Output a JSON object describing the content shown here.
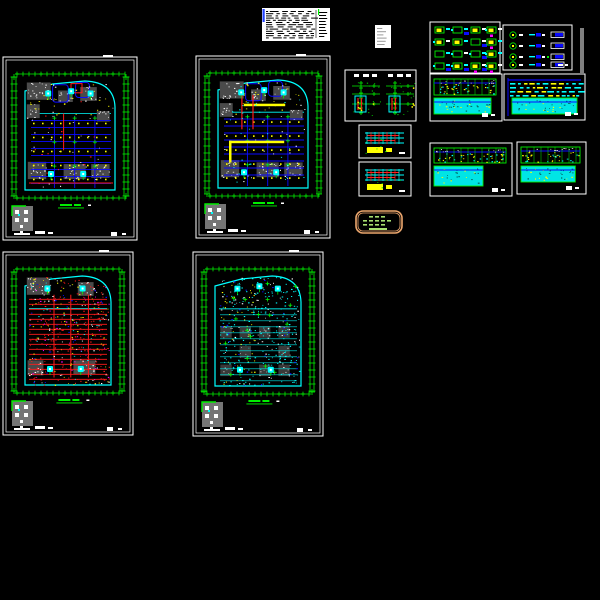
{
  "app": {
    "description": "CAD drawing set - basement electrical floor plans with legends and schedules",
    "background": "#000000"
  },
  "palette": {
    "border": "#ffffff",
    "dim_green": "#00ef00",
    "wall_cyan": "#00ffff",
    "grid_blue": "#0a0aff",
    "accent_red": "#ff1a1a",
    "light_yellow": "#ffff00",
    "hatch_gray": "#4a4a4a",
    "hatch_gray_dark": "#3a3a3a",
    "magenta": "#ff00ff",
    "stamp_orange": "#eda76e",
    "stamp_text": "#a8e070",
    "paper_white": "#ffffff",
    "ink_black": "#000000",
    "soft_gray": "#9a9a9a",
    "key_gray": "#757575",
    "table_cyan": "#00e5e5"
  },
  "sheets": [
    {
      "id": "sheet-plan-top-left",
      "name": "floorplan-sheet-1",
      "x": 3,
      "y": 57,
      "w": 134,
      "h": 183,
      "style": "mixed",
      "seed": 101
    },
    {
      "id": "sheet-plan-top-mid",
      "name": "floorplan-sheet-2",
      "x": 196,
      "y": 56,
      "w": 134,
      "h": 182,
      "style": "mixed-yellow",
      "seed": 202
    },
    {
      "id": "sheet-plan-bottom-left",
      "name": "floorplan-sheet-3",
      "x": 3,
      "y": 252,
      "w": 130,
      "h": 183,
      "style": "red-dense",
      "seed": 303
    },
    {
      "id": "sheet-plan-bottom-mid",
      "name": "floorplan-sheet-4",
      "x": 193,
      "y": 252,
      "w": 130,
      "h": 184,
      "style": "cyan-dense",
      "seed": 404
    }
  ],
  "panels": [
    {
      "id": "notes-block",
      "name": "general-notes-block",
      "type": "notes",
      "x": 262,
      "y": 8,
      "w": 68,
      "h": 33,
      "seed": 7
    },
    {
      "id": "small-card",
      "name": "small-detail-card",
      "type": "card",
      "x": 375,
      "y": 25,
      "w": 16,
      "h": 23,
      "seed": 8
    },
    {
      "id": "riser-panel",
      "name": "riser-detail-panel",
      "type": "riser",
      "x": 345,
      "y": 70,
      "w": 71,
      "h": 51,
      "seed": 9
    },
    {
      "id": "detail-a",
      "name": "section-detail-panel-a",
      "type": "detail",
      "x": 359,
      "y": 125,
      "w": 52,
      "h": 33,
      "seed": 10
    },
    {
      "id": "detail-b",
      "name": "section-detail-panel-b",
      "type": "detail",
      "x": 359,
      "y": 162,
      "w": 52,
      "h": 34,
      "seed": 11
    },
    {
      "id": "stamp",
      "name": "stamp-bubble",
      "type": "stamp",
      "x": 356,
      "y": 211,
      "w": 46,
      "h": 22,
      "seed": 12
    },
    {
      "id": "legend-1",
      "name": "symbol-legend-panel-1",
      "type": "legend1",
      "x": 430,
      "y": 22,
      "w": 70,
      "h": 51,
      "seed": 13
    },
    {
      "id": "legend-2",
      "name": "symbol-legend-panel-2",
      "type": "legend2",
      "x": 503,
      "y": 25,
      "w": 69,
      "h": 45,
      "seed": 14
    },
    {
      "id": "divider",
      "name": "vertical-divider-line",
      "type": "divider",
      "x": 581,
      "y": 28,
      "w": 2,
      "h": 45,
      "seed": 15
    },
    {
      "id": "schedule-1",
      "name": "equipment-schedule-1",
      "type": "schedule",
      "variant": "two-strip",
      "x": 430,
      "y": 74,
      "w": 72,
      "h": 47,
      "seed": 16
    },
    {
      "id": "schedule-2",
      "name": "equipment-schedule-2",
      "type": "schedule",
      "variant": "dense",
      "x": 504,
      "y": 74,
      "w": 81,
      "h": 46,
      "seed": 17
    },
    {
      "id": "schedule-3",
      "name": "equipment-schedule-3",
      "type": "schedule",
      "variant": "two-strip-wide",
      "x": 430,
      "y": 143,
      "w": 82,
      "h": 53,
      "seed": 18
    },
    {
      "id": "schedule-4",
      "name": "equipment-schedule-4",
      "type": "schedule",
      "variant": "two-strip",
      "x": 517,
      "y": 142,
      "w": 69,
      "h": 52,
      "seed": 19
    }
  ]
}
